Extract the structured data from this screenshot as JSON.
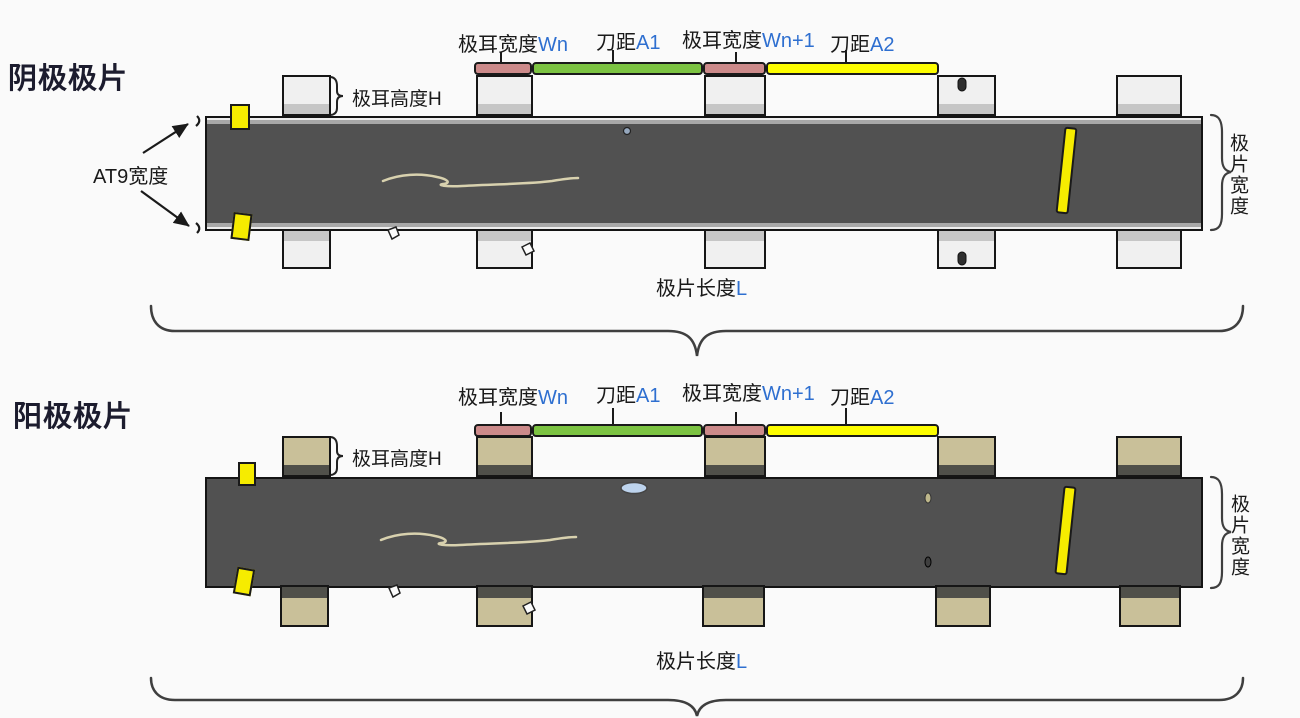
{
  "page": {
    "background": "#fafafa"
  },
  "colors": {
    "page_bg": "#fafafa",
    "strip": "#515151",
    "cathode_tab": "#f0f0f0",
    "cathode_tab_band": "#c6c6c6",
    "anode_tab": "#c9c099",
    "anode_tab_band": "#50504a",
    "bar_pink": "#cc8a8a",
    "bar_green": "#7cc342",
    "bar_yellow": "#fdfd00",
    "marker_yellow": "#f6ec00",
    "accent_blue": "#2e6fd0"
  },
  "labels": {
    "tab_width_wn": {
      "text": "极耳宽度",
      "var": "Wn"
    },
    "knife_a1": {
      "text": "刀距",
      "var": "A1"
    },
    "tab_width_wn1": {
      "text": "极耳宽度",
      "var": "Wn+1"
    },
    "knife_a2": {
      "text": "刀距",
      "var": "A2"
    },
    "tab_height": {
      "text": "极耳高度",
      "var": "H"
    },
    "sheet_length": {
      "text": "极片长度",
      "var": "L"
    },
    "sheet_width_vertical": "极片宽度",
    "at9_width": "AT9宽度"
  },
  "diagrams": [
    {
      "title": "阴极极片",
      "type": "cathode"
    },
    {
      "title": "阳极极片",
      "type": "anode"
    }
  ]
}
